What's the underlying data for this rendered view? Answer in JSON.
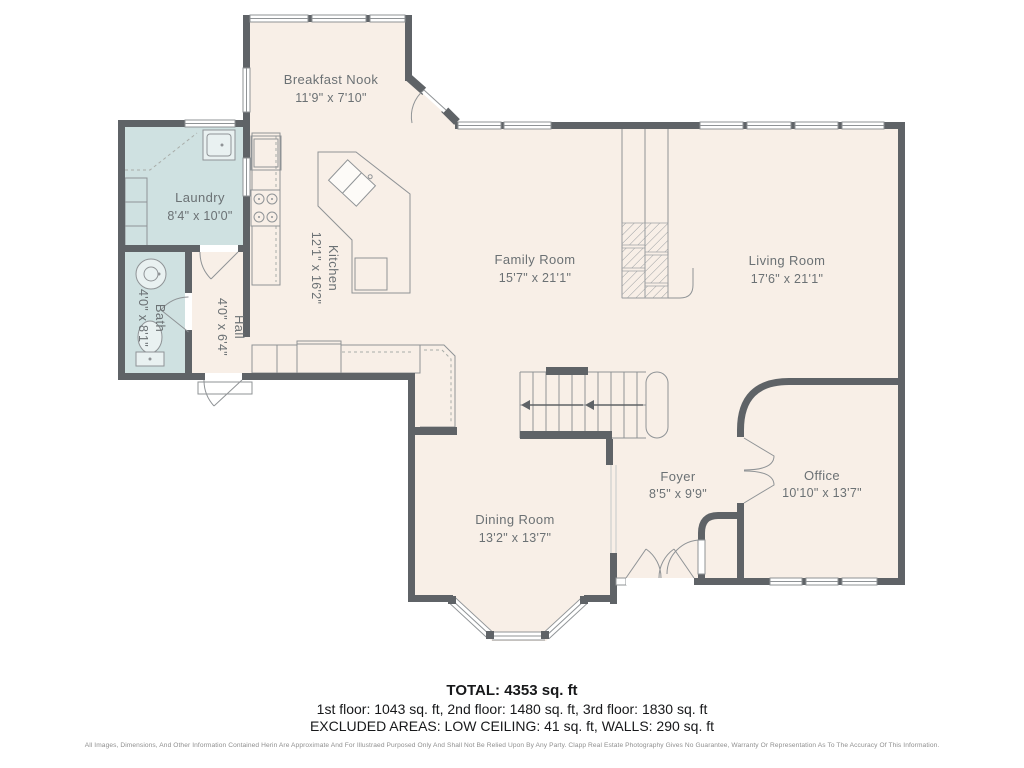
{
  "colors": {
    "wall": "#5f6367",
    "floor": "#f8efe7",
    "wet_floor": "#cfe1e1",
    "line": "#8f9396",
    "label_text": "#6b7174"
  },
  "plan": {
    "rooms": [
      {
        "id": "breakfast-nook",
        "name": "Breakfast Nook",
        "dims": "11'9\" x 7'10\""
      },
      {
        "id": "laundry",
        "name": "Laundry",
        "dims": "8'4\" x 10'0\""
      },
      {
        "id": "kitchen",
        "name": "Kitchen",
        "dims": "12'1\" x 16'2\""
      },
      {
        "id": "family-room",
        "name": "Family Room",
        "dims": "15'7\" x 21'1\""
      },
      {
        "id": "living-room",
        "name": "Living Room",
        "dims": "17'6\" x 21'1\""
      },
      {
        "id": "bath",
        "name": "Bath",
        "dims": "4'0\" x 8'1\""
      },
      {
        "id": "hall",
        "name": "Hall",
        "dims": "4'0\" x 6'4\""
      },
      {
        "id": "dining-room",
        "name": "Dining Room",
        "dims": "13'2\" x 13'7\""
      },
      {
        "id": "foyer",
        "name": "Foyer",
        "dims": "8'5\" x 9'9\""
      },
      {
        "id": "office",
        "name": "Office",
        "dims": "10'10\" x 13'7\""
      }
    ]
  },
  "summary": {
    "total": "TOTAL: 4353 sq. ft",
    "floors": "1st floor: 1043 sq. ft, 2nd floor: 1480 sq. ft, 3rd floor: 1830 sq. ft",
    "excluded": "EXCLUDED AREAS: LOW CEILING: 41 sq. ft, WALLS: 290 sq. ft",
    "disclaimer": "All Images, Dimensions, And Other Information Contained Herin Are Approximate And For Illustraed Purposed Only And Shall Not Be Relied Upon By Any Party. Clapp Real Estate Photography Gives No Guarantee, Warranty Or Representation As To The Accuracy Of This Information."
  }
}
